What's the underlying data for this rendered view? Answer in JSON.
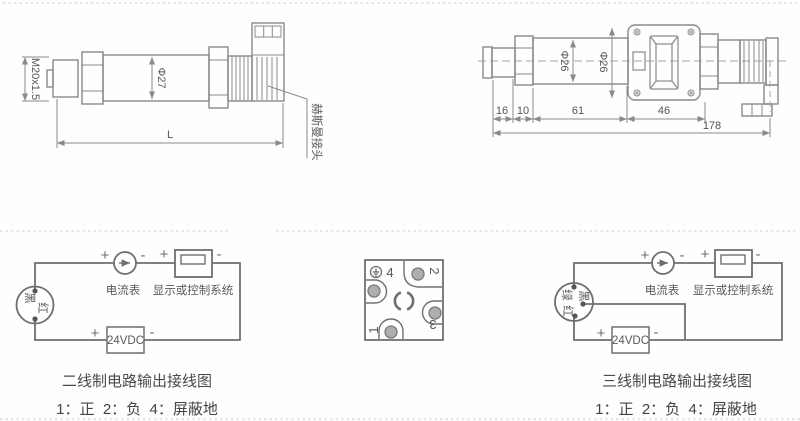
{
  "device_left": {
    "thread_label": "M20x1.5",
    "diameter_label": "Φ27",
    "length_label": "L",
    "connector_label": "赫斯曼接头"
  },
  "device_right": {
    "diameter_body_label": "Φ26",
    "diameter_head_label": "Φ26",
    "dims": {
      "d16": "16",
      "d10": "10",
      "d61": "61",
      "d46": "46",
      "total": "178"
    }
  },
  "pinout": {
    "pin4": "4",
    "pin2": "2",
    "pin1": "1",
    "pin3": "3"
  },
  "signs": {
    "plus": "+",
    "minus": "-"
  },
  "two_wire": {
    "wire_black": "黑",
    "wire_red": "红",
    "ammeter_label": "电流表",
    "display_label": "显示或控制系统",
    "supply_label": "24VDC",
    "title": "二线制电路输出接线图",
    "legend": "1：正  2：负  4：屏蔽地"
  },
  "three_wire": {
    "wire_green": "绿",
    "wire_black": "黑",
    "wire_red": "红",
    "ammeter_label": "电流表",
    "display_label": "显示或控制系统",
    "supply_label": "24VDC",
    "title": "三线制电路输出接线图",
    "legend": "1：正  2：负  4：屏蔽地"
  },
  "colors": {
    "drawing_line": "#8a8a8a",
    "circuit_line": "#6f6f6f",
    "text": "#555555",
    "pin_fill": "#aeaeae",
    "separator": "#d9d9d9"
  }
}
